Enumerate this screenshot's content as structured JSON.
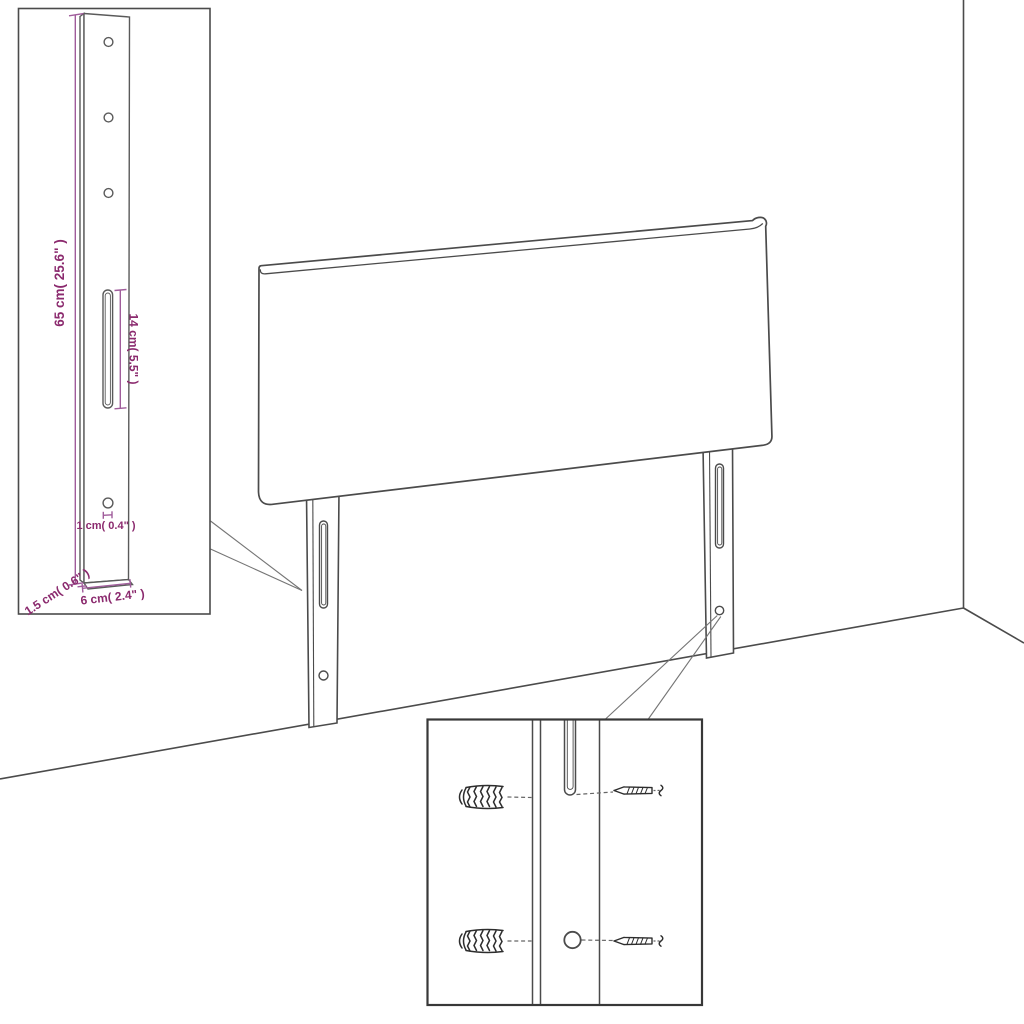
{
  "figure": {
    "title": "Headboard assembly diagram",
    "background": "#ffffff",
    "colors": {
      "outline": "#4b4b4b",
      "inset_outline": "#5a5a5a",
      "hardware": "#2d2d2d",
      "callout": "#757575",
      "dimension_line": "#a05c9b",
      "dimension_text": "#8b2a6e"
    },
    "insets": {
      "leg_detail": {
        "holes_top": 3,
        "holes_bottom": 1,
        "slots": 1,
        "dimensions": {
          "height": "65 cm( 25.6\" )",
          "slot_length": "14 cm( 5.5\" )",
          "hole_diameter": "1 cm( 0.4\" )",
          "thickness": "1.5 cm( 0.6\" )",
          "width": "6 cm( 2.4\" )"
        }
      },
      "mounting_detail": {
        "rows": 2,
        "hardware": [
          "wall-plug",
          "screw"
        ]
      }
    },
    "main": {
      "subject": "headboard with two slotted legs",
      "legs": 2,
      "slots_per_leg": 1,
      "holes_per_leg": 1
    }
  }
}
